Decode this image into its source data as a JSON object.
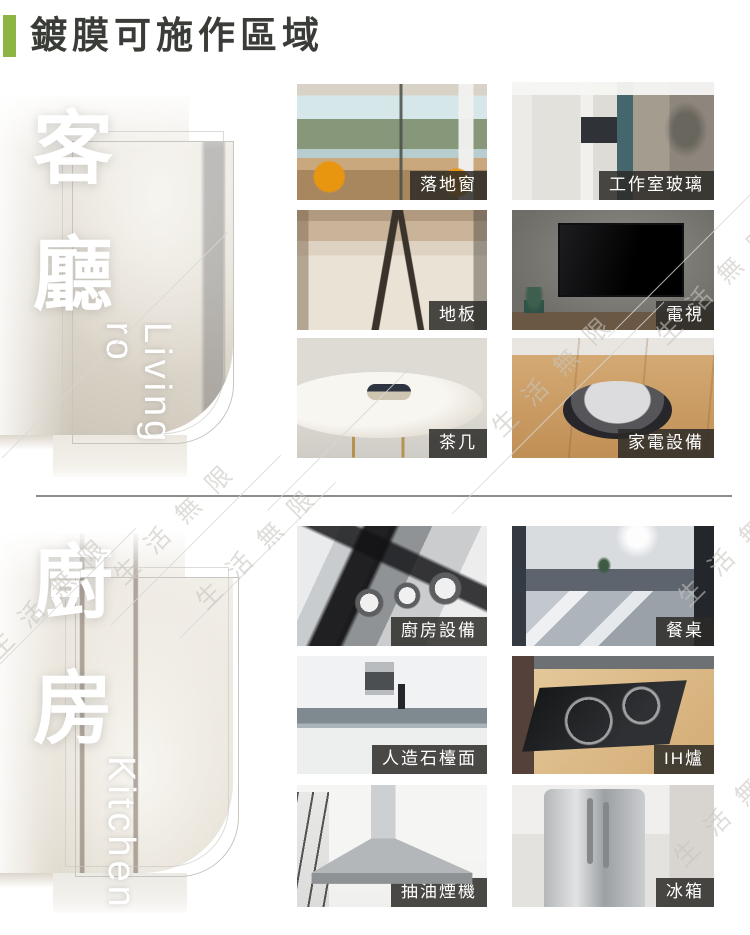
{
  "header": {
    "title": "鍍膜可施作區域",
    "accent_color": "#8db544",
    "title_color": "#3a3c37"
  },
  "watermark": {
    "text": "生活無限"
  },
  "label_style": {
    "bg": "rgba(44,42,39,0.85)",
    "text_color": "#ffffff"
  },
  "living": {
    "name_zh": "客廳",
    "name_en": "Living ro",
    "items": [
      {
        "label": "落地窗",
        "photo": "floor-to-ceiling-window"
      },
      {
        "label": "工作室玻璃",
        "photo": "studio-glass"
      },
      {
        "label": "地板",
        "photo": "floor"
      },
      {
        "label": "電視",
        "photo": "tv"
      },
      {
        "label": "茶几",
        "photo": "coffee-table"
      },
      {
        "label": "家電設備",
        "photo": "home-appliance-robot-vacuum"
      }
    ]
  },
  "kitchen": {
    "name_zh": "廚房",
    "name_en": "Kitchen",
    "items": [
      {
        "label": "廚房設備",
        "photo": "kitchen-equipment-stove"
      },
      {
        "label": "餐桌",
        "photo": "dining-table"
      },
      {
        "label": "人造石檯面",
        "photo": "artificial-stone-countertop"
      },
      {
        "label": "IH爐",
        "photo": "ih-induction-stove"
      },
      {
        "label": "抽油煙機",
        "photo": "range-hood"
      },
      {
        "label": "冰箱",
        "photo": "refrigerator"
      }
    ]
  }
}
